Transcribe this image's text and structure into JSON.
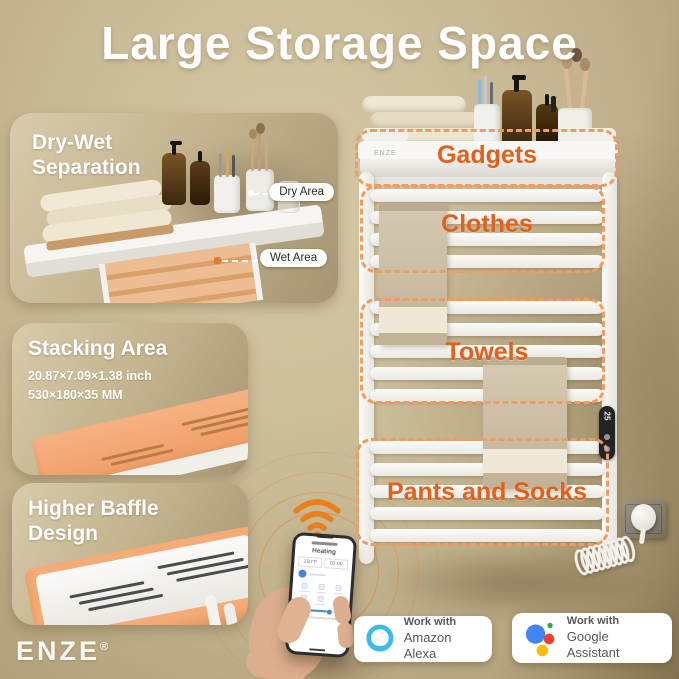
{
  "title": "Large Storage Space",
  "brand": {
    "logo_text": "ENZE",
    "registered_mark": "®"
  },
  "cards": {
    "dry_wet": {
      "heading_line1": "Dry-Wet",
      "heading_line2": "Separation",
      "dry_callout": "Dry Area",
      "wet_callout": "Wet Area"
    },
    "stacking": {
      "heading": "Stacking Area",
      "size_inch": "20.87×7.09×1.38 inch",
      "size_mm": "530×180×35 MM"
    },
    "baffle": {
      "heading_line1": "Higher Baffle",
      "heading_line2": "Design"
    }
  },
  "rack": {
    "shelf_brand": "ENZE",
    "controller_display": "25",
    "labels": {
      "gadgets": "Gadgets",
      "clothes": "Clothes",
      "towels": "Towels",
      "pants": "Pants and Socks"
    }
  },
  "phone_app": {
    "status": "Heating",
    "temperature": "150°F",
    "timer": "02:00"
  },
  "badges": {
    "alexa": {
      "line1": "Work with",
      "line2": "Amazon Alexa"
    },
    "google": {
      "line1": "Work with",
      "line2": "Google Assistant"
    }
  },
  "icons": {
    "wifi": "wifi-icon",
    "alexa": "alexa-ring-icon",
    "google_assistant": "google-assistant-dots-icon"
  },
  "colors": {
    "background_tan": "#c8b995",
    "accent_label_orange": "#e25f1c",
    "dashed_border_orange": "#f09b60",
    "highlight_shelf_orange": "#f2a979",
    "alexa_blue": "#38bdea",
    "google_blue": "#4285f4",
    "google_red": "#ea4335",
    "google_yellow": "#fbbc05",
    "google_green": "#34a853",
    "badge_text_gray": "#55585c"
  }
}
